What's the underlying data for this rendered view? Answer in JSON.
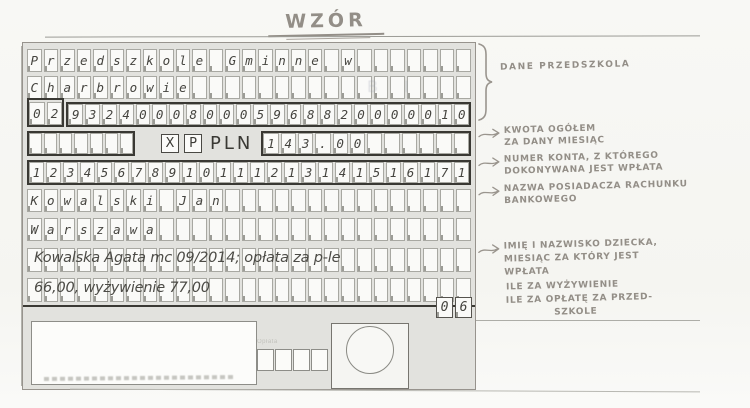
{
  "title": "WZÓR",
  "form": {
    "recipient_line1": "Przedszkole Gminne w",
    "recipient_line2": "Charbrowie",
    "recipient_account_prefix": "02",
    "recipient_account_rest": "932400080005968820000010",
    "wp_w": "X",
    "wp_p": "P",
    "currency": "PLN",
    "amount": "143.00",
    "payer_account": "12345678910111213141516171",
    "payer_name": "Kowalski Jan",
    "payer_city": "Warszawa",
    "payment_title": "Kowalska Agata mc 09/2014; opłata za p-le",
    "payment_title2": "66,00, wyżywienie 77,00",
    "page_code": "06",
    "fee_label": "Opłata",
    "watermark": "BI"
  },
  "annotations": {
    "preschool_data": {
      "lines": [
        "DANE PRZEDSZKOLA"
      ]
    },
    "total_amount": {
      "lines": [
        "KWOTA OGÓŁEM",
        "ZA DANY MIESIĄC"
      ]
    },
    "source_account": {
      "lines": [
        "NUMER KONTA, Z KTÓREGO",
        "DOKONYWANA JEST WPŁATA"
      ]
    },
    "account_holder": {
      "lines": [
        "NAZWA POSIADACZA RACHUNKU",
        "BANKOWEGO"
      ]
    },
    "child_info": {
      "lines": [
        "IMIĘ I NAZWISKO DZIECKA,",
        "MIESIĄC ZA KTÓRY JEST",
        "WPŁATA"
      ]
    },
    "food_cost": {
      "lines": [
        "ILE ZA WYŻYWIENIE"
      ]
    },
    "preschool_fee": {
      "lines": [
        "ILE ZA OPŁATĘ ZA PRZED-",
        "SZKOLE"
      ]
    }
  }
}
